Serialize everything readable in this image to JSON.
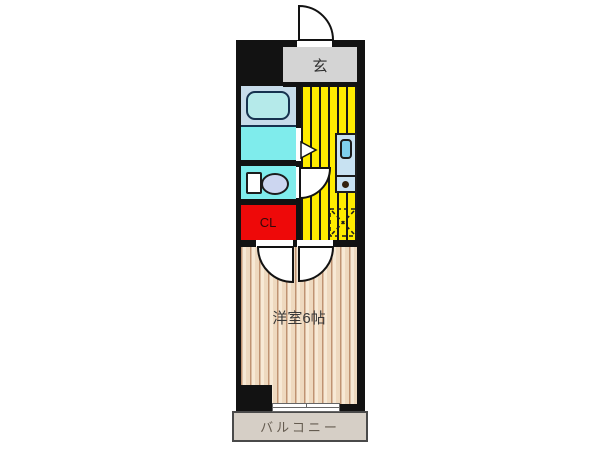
{
  "floorplan": {
    "rooms": {
      "entrance": {
        "label": "玄"
      },
      "closet": {
        "label": "CL"
      },
      "western_room": {
        "label": "洋室6帖"
      },
      "balcony": {
        "label": "バルコニー"
      }
    },
    "fixtures": [
      "entrance-door-swing",
      "bathtub",
      "washroom",
      "toilet",
      "kitchen-sink",
      "stove-burner",
      "refrigerator-space",
      "closet-door-swing",
      "kitchen-door-swing",
      "toilet-door-swing",
      "washroom-door",
      "balcony-window"
    ],
    "colors": {
      "wall": "#121212",
      "entrance_gray": "#d4d4d4",
      "kitchen_yellow": "#ffec00",
      "bath_cyan": "#7fecec",
      "bath_panel_blue": "#c7dcea",
      "tub_fill": "#b5eaea",
      "closet_red": "#ee0909",
      "fixture_blue": "#c8e2f2",
      "sink_blue": "#7fd0ee",
      "toilet_bowl_blue": "#ccd6f0",
      "wood_light": "#f7e9d5",
      "wood_dark": "#eed9bf",
      "wood_line": "#bf9372",
      "balcony_gray": "#d6cfc6"
    }
  }
}
